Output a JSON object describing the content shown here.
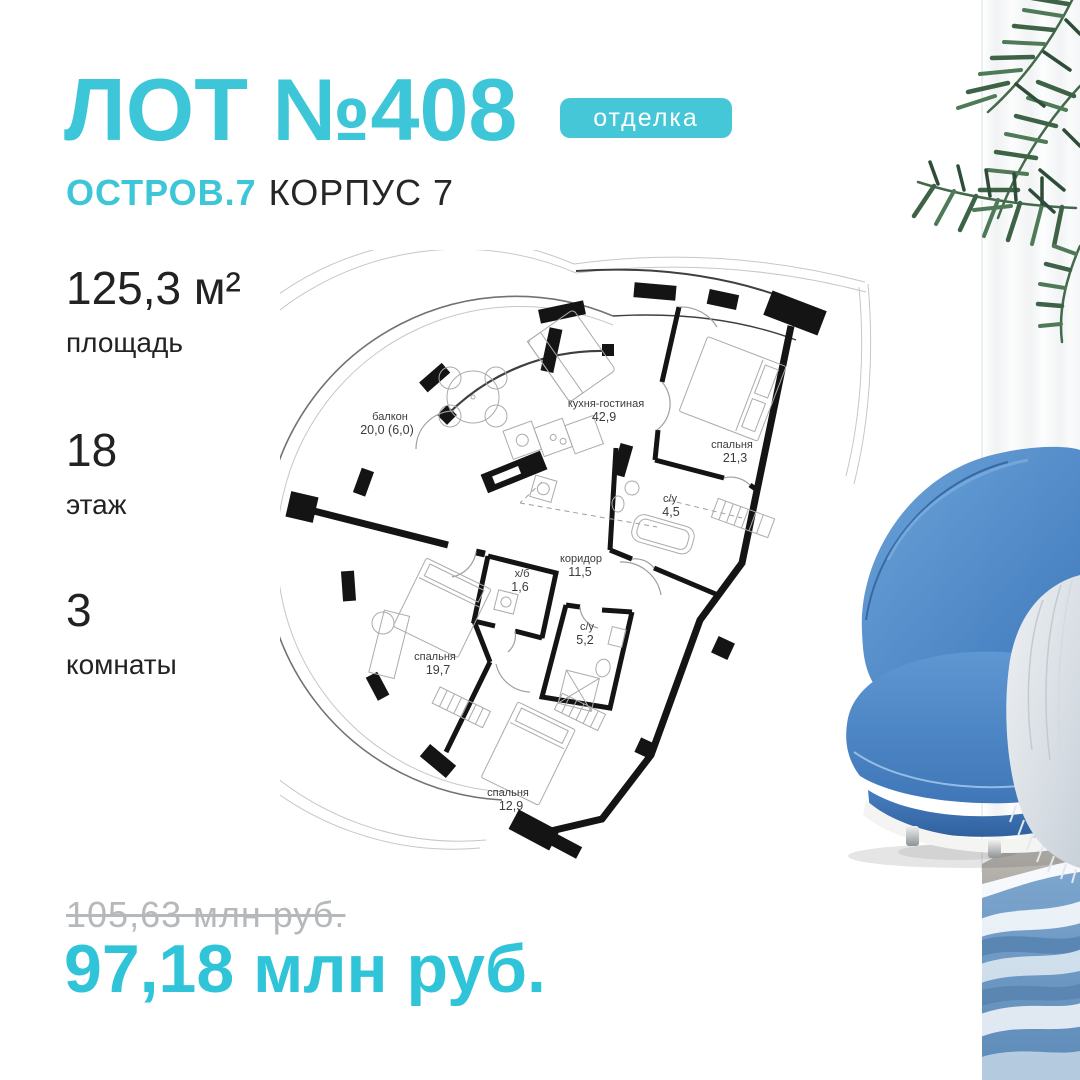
{
  "colors": {
    "accent": "#3DC6D7",
    "badge": "#45C7D8",
    "dark_text": "#222222",
    "muted_price": "#B5B9BB"
  },
  "header": {
    "lot": "ЛОТ №408",
    "badge": "отделка",
    "project": "ОСТРОВ.7",
    "building": "КОРПУС 7"
  },
  "stats": [
    {
      "value": "125,3 м²",
      "label": "площадь"
    },
    {
      "value": "18",
      "label": "этаж"
    },
    {
      "value": "3",
      "label": "комнаты"
    }
  ],
  "floorplan": {
    "rooms": [
      {
        "name": "балкон",
        "area": "20,0 (6,0)"
      },
      {
        "name": "кухня-гостиная",
        "area": "42,9"
      },
      {
        "name": "спальня",
        "area": "21,3"
      },
      {
        "name": "с/у",
        "area": "4,5"
      },
      {
        "name": "коридор",
        "area": "11,5"
      },
      {
        "name": "х/б",
        "area": "1,6"
      },
      {
        "name": "с/у",
        "area": "5,2"
      },
      {
        "name": "спальня",
        "area": "19,7"
      },
      {
        "name": "спальня",
        "area": "12,9"
      }
    ]
  },
  "pricing": {
    "old": "105,63 млн руб.",
    "current": "97,18 млн руб."
  }
}
